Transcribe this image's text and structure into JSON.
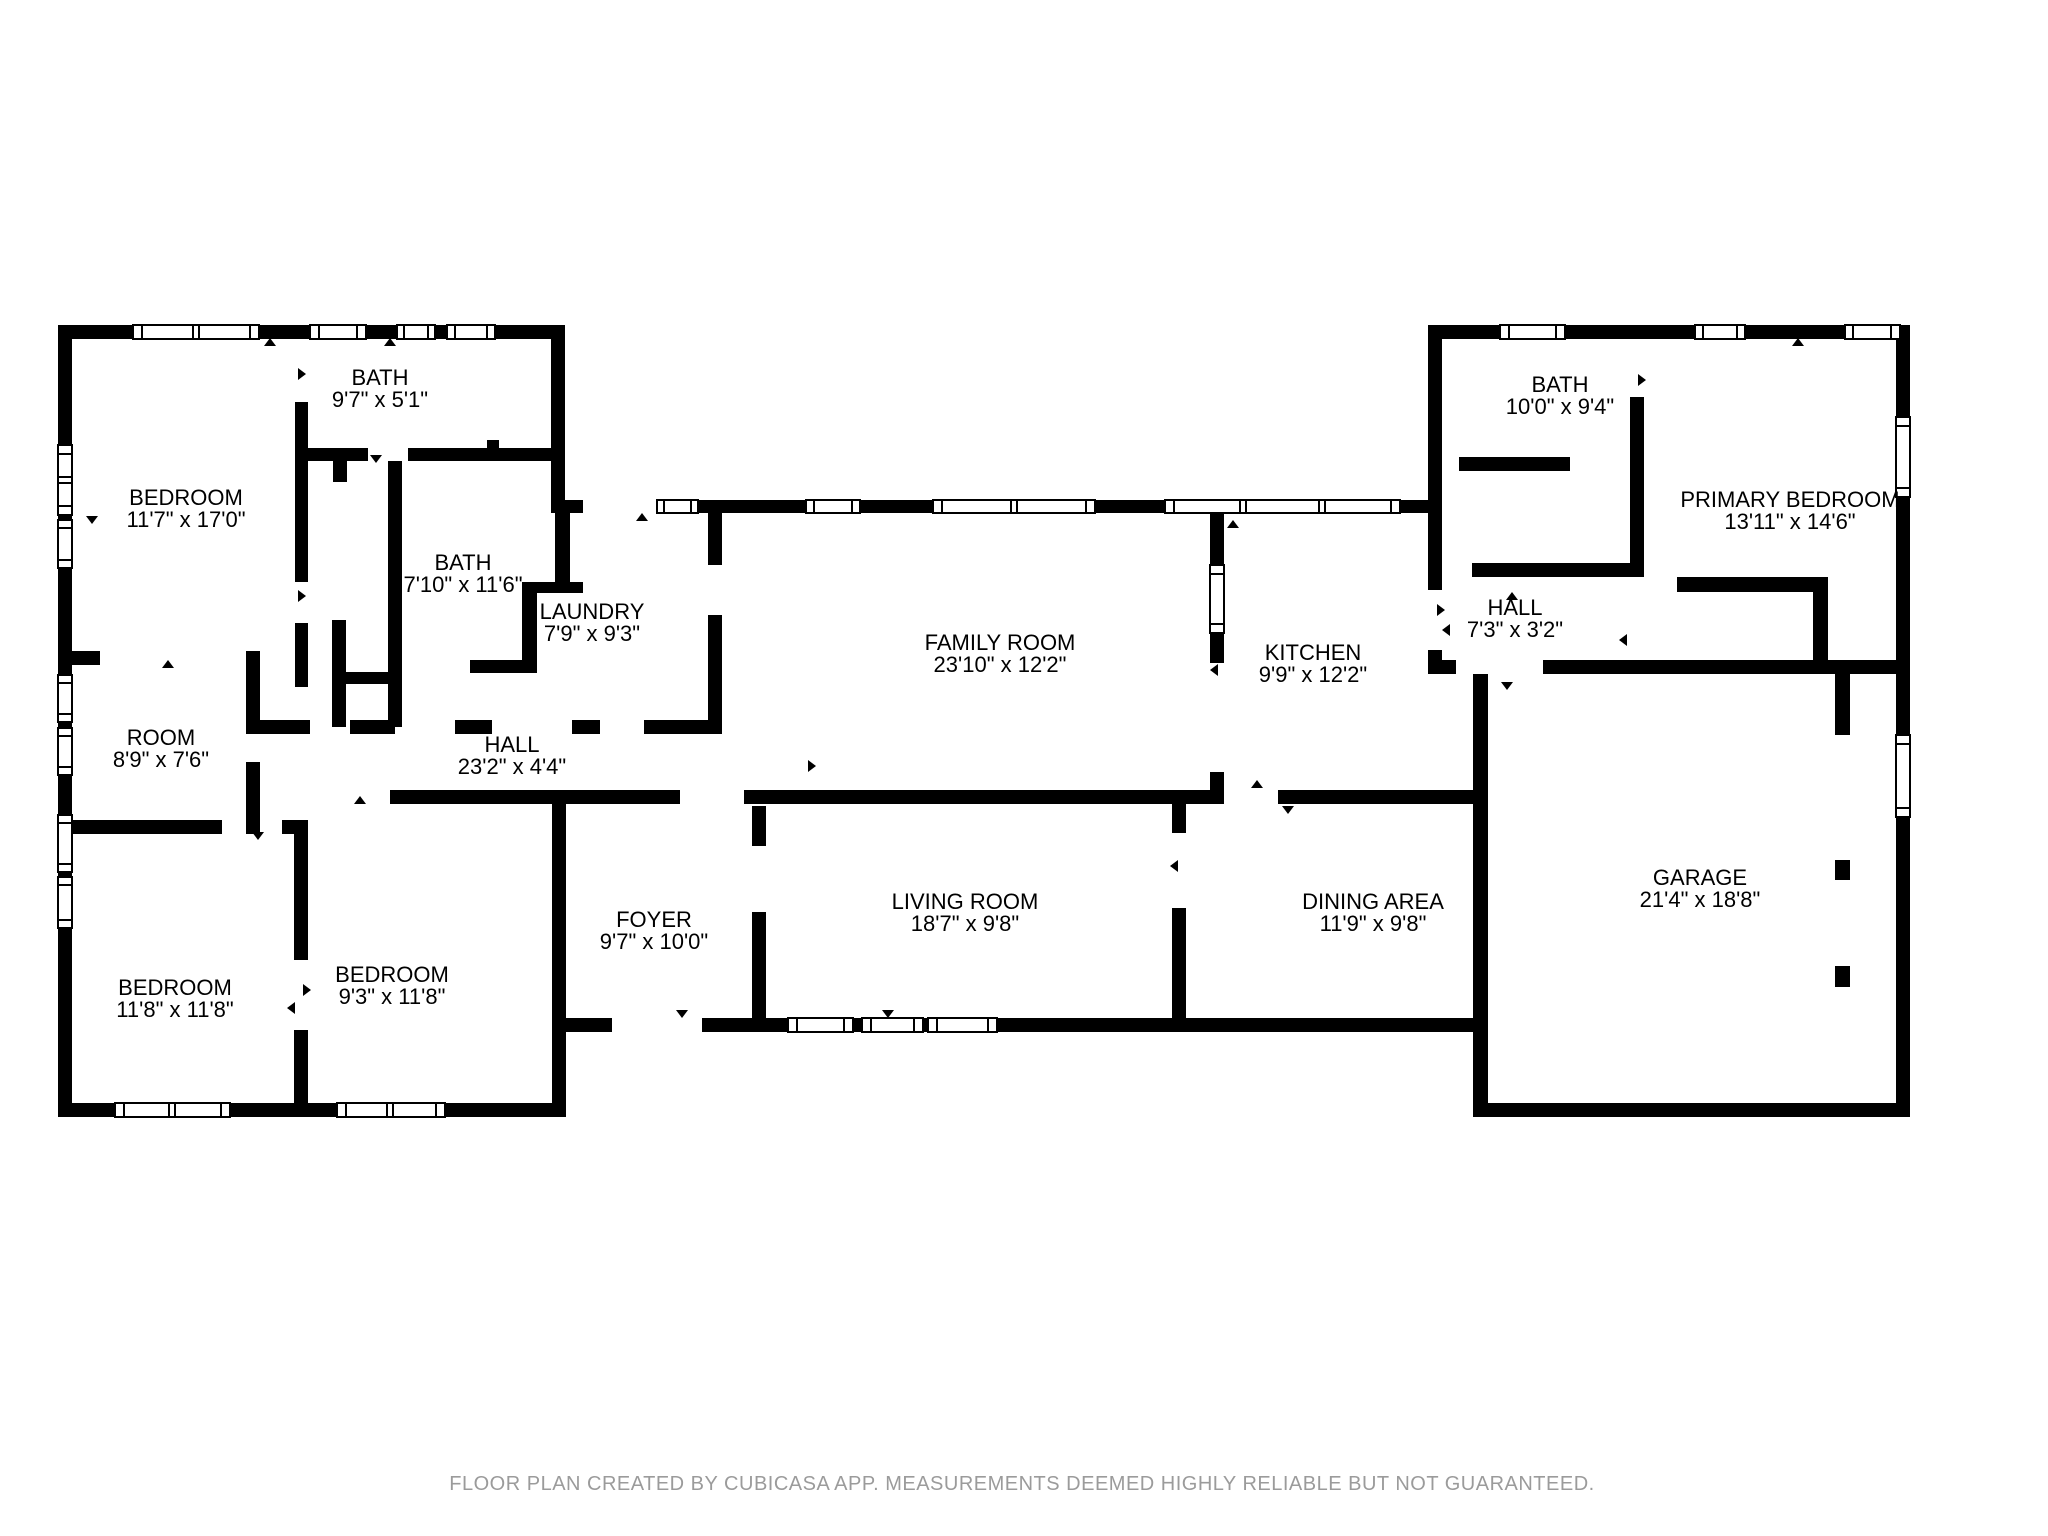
{
  "plan": {
    "app_attribution": "FLOOR PLAN CREATED BY CUBICASA APP. MEASUREMENTS DEEMED HIGHLY RELIABLE BUT NOT GUARANTEED.",
    "wall_color": "#000000",
    "label_color": "#000000",
    "disclaimer_color": "#9b9b9b",
    "background_color": "#ffffff"
  },
  "rooms": [
    {
      "id": "bath-upper-left",
      "name": "BATH",
      "dims": "9'7\" x 5'1\""
    },
    {
      "id": "bedroom-upper-left",
      "name": "BEDROOM",
      "dims": "11'7\" x 17'0\""
    },
    {
      "id": "bath-mid-left",
      "name": "BATH",
      "dims": "7'10\" x 11'6\""
    },
    {
      "id": "laundry",
      "name": "LAUNDRY",
      "dims": "7'9\" x 9'3\""
    },
    {
      "id": "family-room",
      "name": "FAMILY ROOM",
      "dims": "23'10\" x 12'2\""
    },
    {
      "id": "kitchen",
      "name": "KITCHEN",
      "dims": "9'9\" x 12'2\""
    },
    {
      "id": "bath-right",
      "name": "BATH",
      "dims": "10'0\" x 9'4\""
    },
    {
      "id": "primary-bedroom",
      "name": "PRIMARY BEDROOM",
      "dims": "13'11\" x 14'6\""
    },
    {
      "id": "hall-right",
      "name": "HALL",
      "dims": "7'3\" x 3'2\""
    },
    {
      "id": "room",
      "name": "ROOM",
      "dims": "8'9\" x 7'6\""
    },
    {
      "id": "hall-left",
      "name": "HALL",
      "dims": "23'2\" x 4'4\""
    },
    {
      "id": "foyer",
      "name": "FOYER",
      "dims": "9'7\" x 10'0\""
    },
    {
      "id": "living-room",
      "name": "LIVING ROOM",
      "dims": "18'7\" x 9'8\""
    },
    {
      "id": "dining-area",
      "name": "DINING AREA",
      "dims": "11'9\" x 9'8\""
    },
    {
      "id": "garage",
      "name": "GARAGE",
      "dims": "21'4\" x 18'8\""
    },
    {
      "id": "bedroom-lower-left",
      "name": "BEDROOM",
      "dims": "11'8\" x 11'8\""
    },
    {
      "id": "bedroom-lower-mid",
      "name": "BEDROOM",
      "dims": "9'3\" x 11'8\""
    }
  ]
}
